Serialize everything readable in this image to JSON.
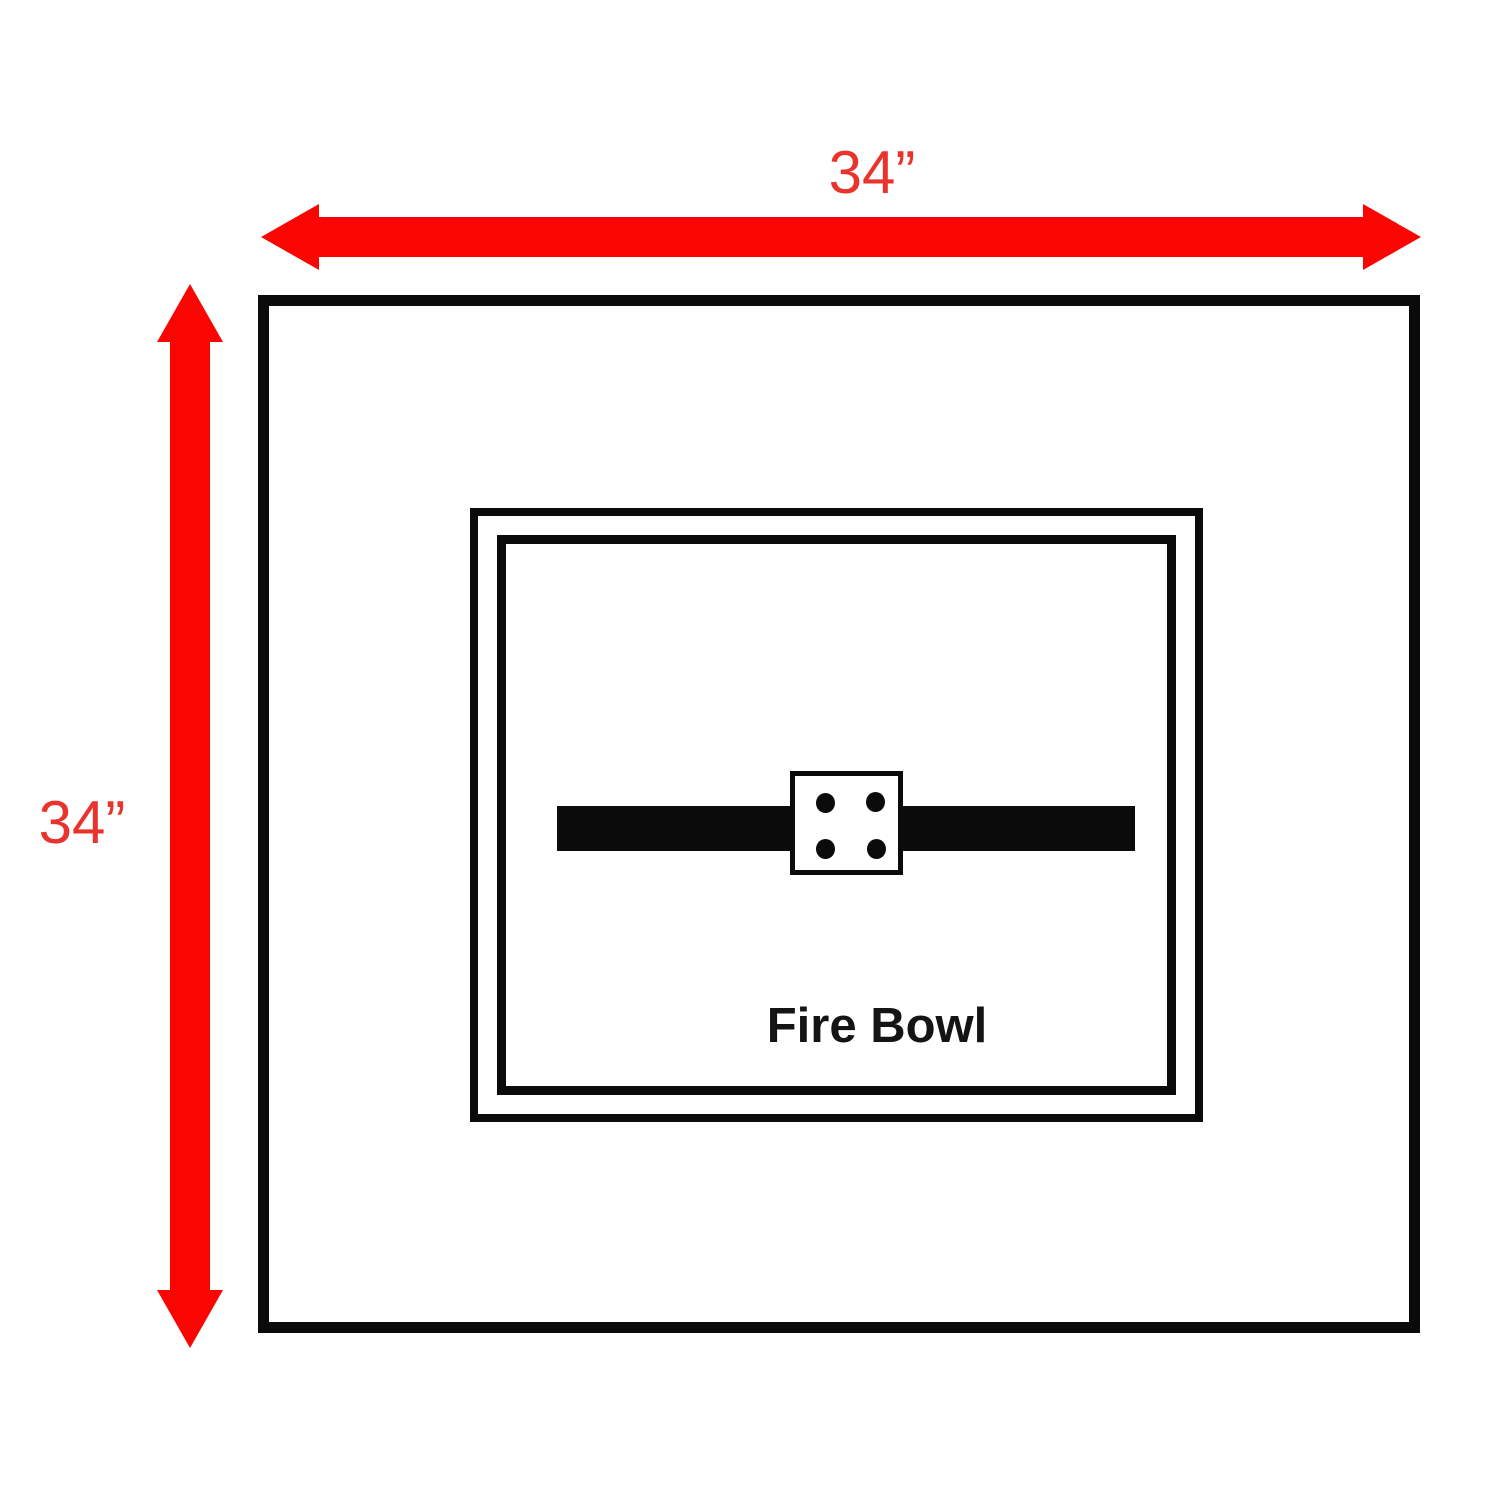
{
  "diagram": {
    "width_label": "34”",
    "height_label": "34”",
    "fire_bowl_label": "Fire Bowl"
  },
  "colors": {
    "arrow_red": "#fb0502",
    "label_red": "#e8342c",
    "line_black": "#0b0b0b",
    "background": "#ffffff"
  }
}
